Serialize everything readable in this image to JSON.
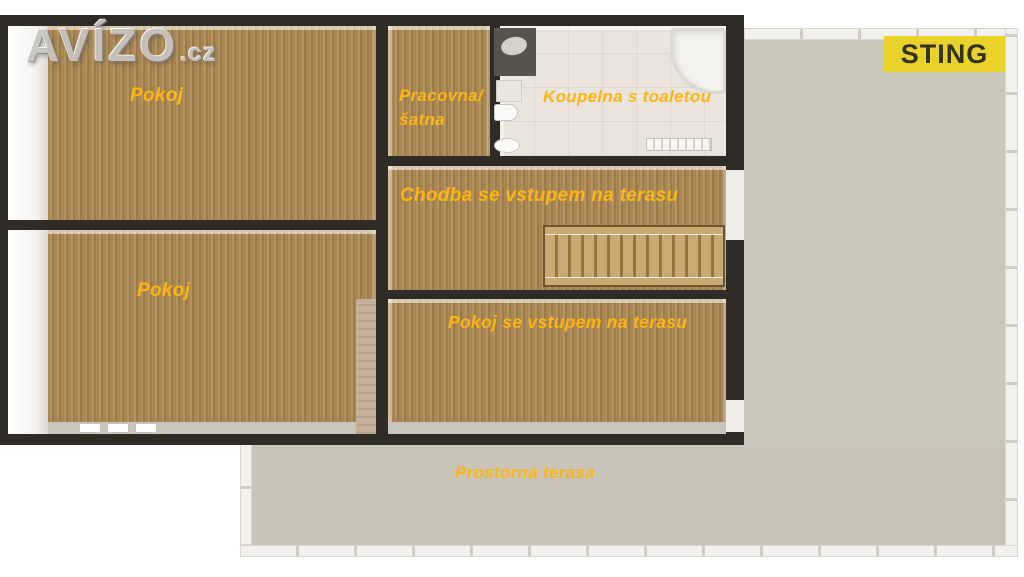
{
  "watermark": {
    "brand": "AVÍZO",
    "suffix": ".cz"
  },
  "badge": {
    "label": "STING"
  },
  "rooms": {
    "pokoj_top": "Pokoj",
    "pokoj_bottom": "Pokoj",
    "pracovna_line1": "Pracovna/",
    "pracovna_line2": "šatna",
    "koupelna": "Koupelna s toaletou",
    "chodba": "Chodba se vstupem na terasu",
    "pokoj_terasa": "Pokoj se vstupem na terasu",
    "terasa": "Prostorná terasa"
  },
  "colors": {
    "label_text": "#fbb515",
    "wood_floor": "#aa8750",
    "wall": "#2f2c28",
    "terrace_floor": "#c9c4b7",
    "bathroom_tile": "#eae4dc",
    "badge_bg": "#e9d32b",
    "badge_fg": "#33321f"
  }
}
